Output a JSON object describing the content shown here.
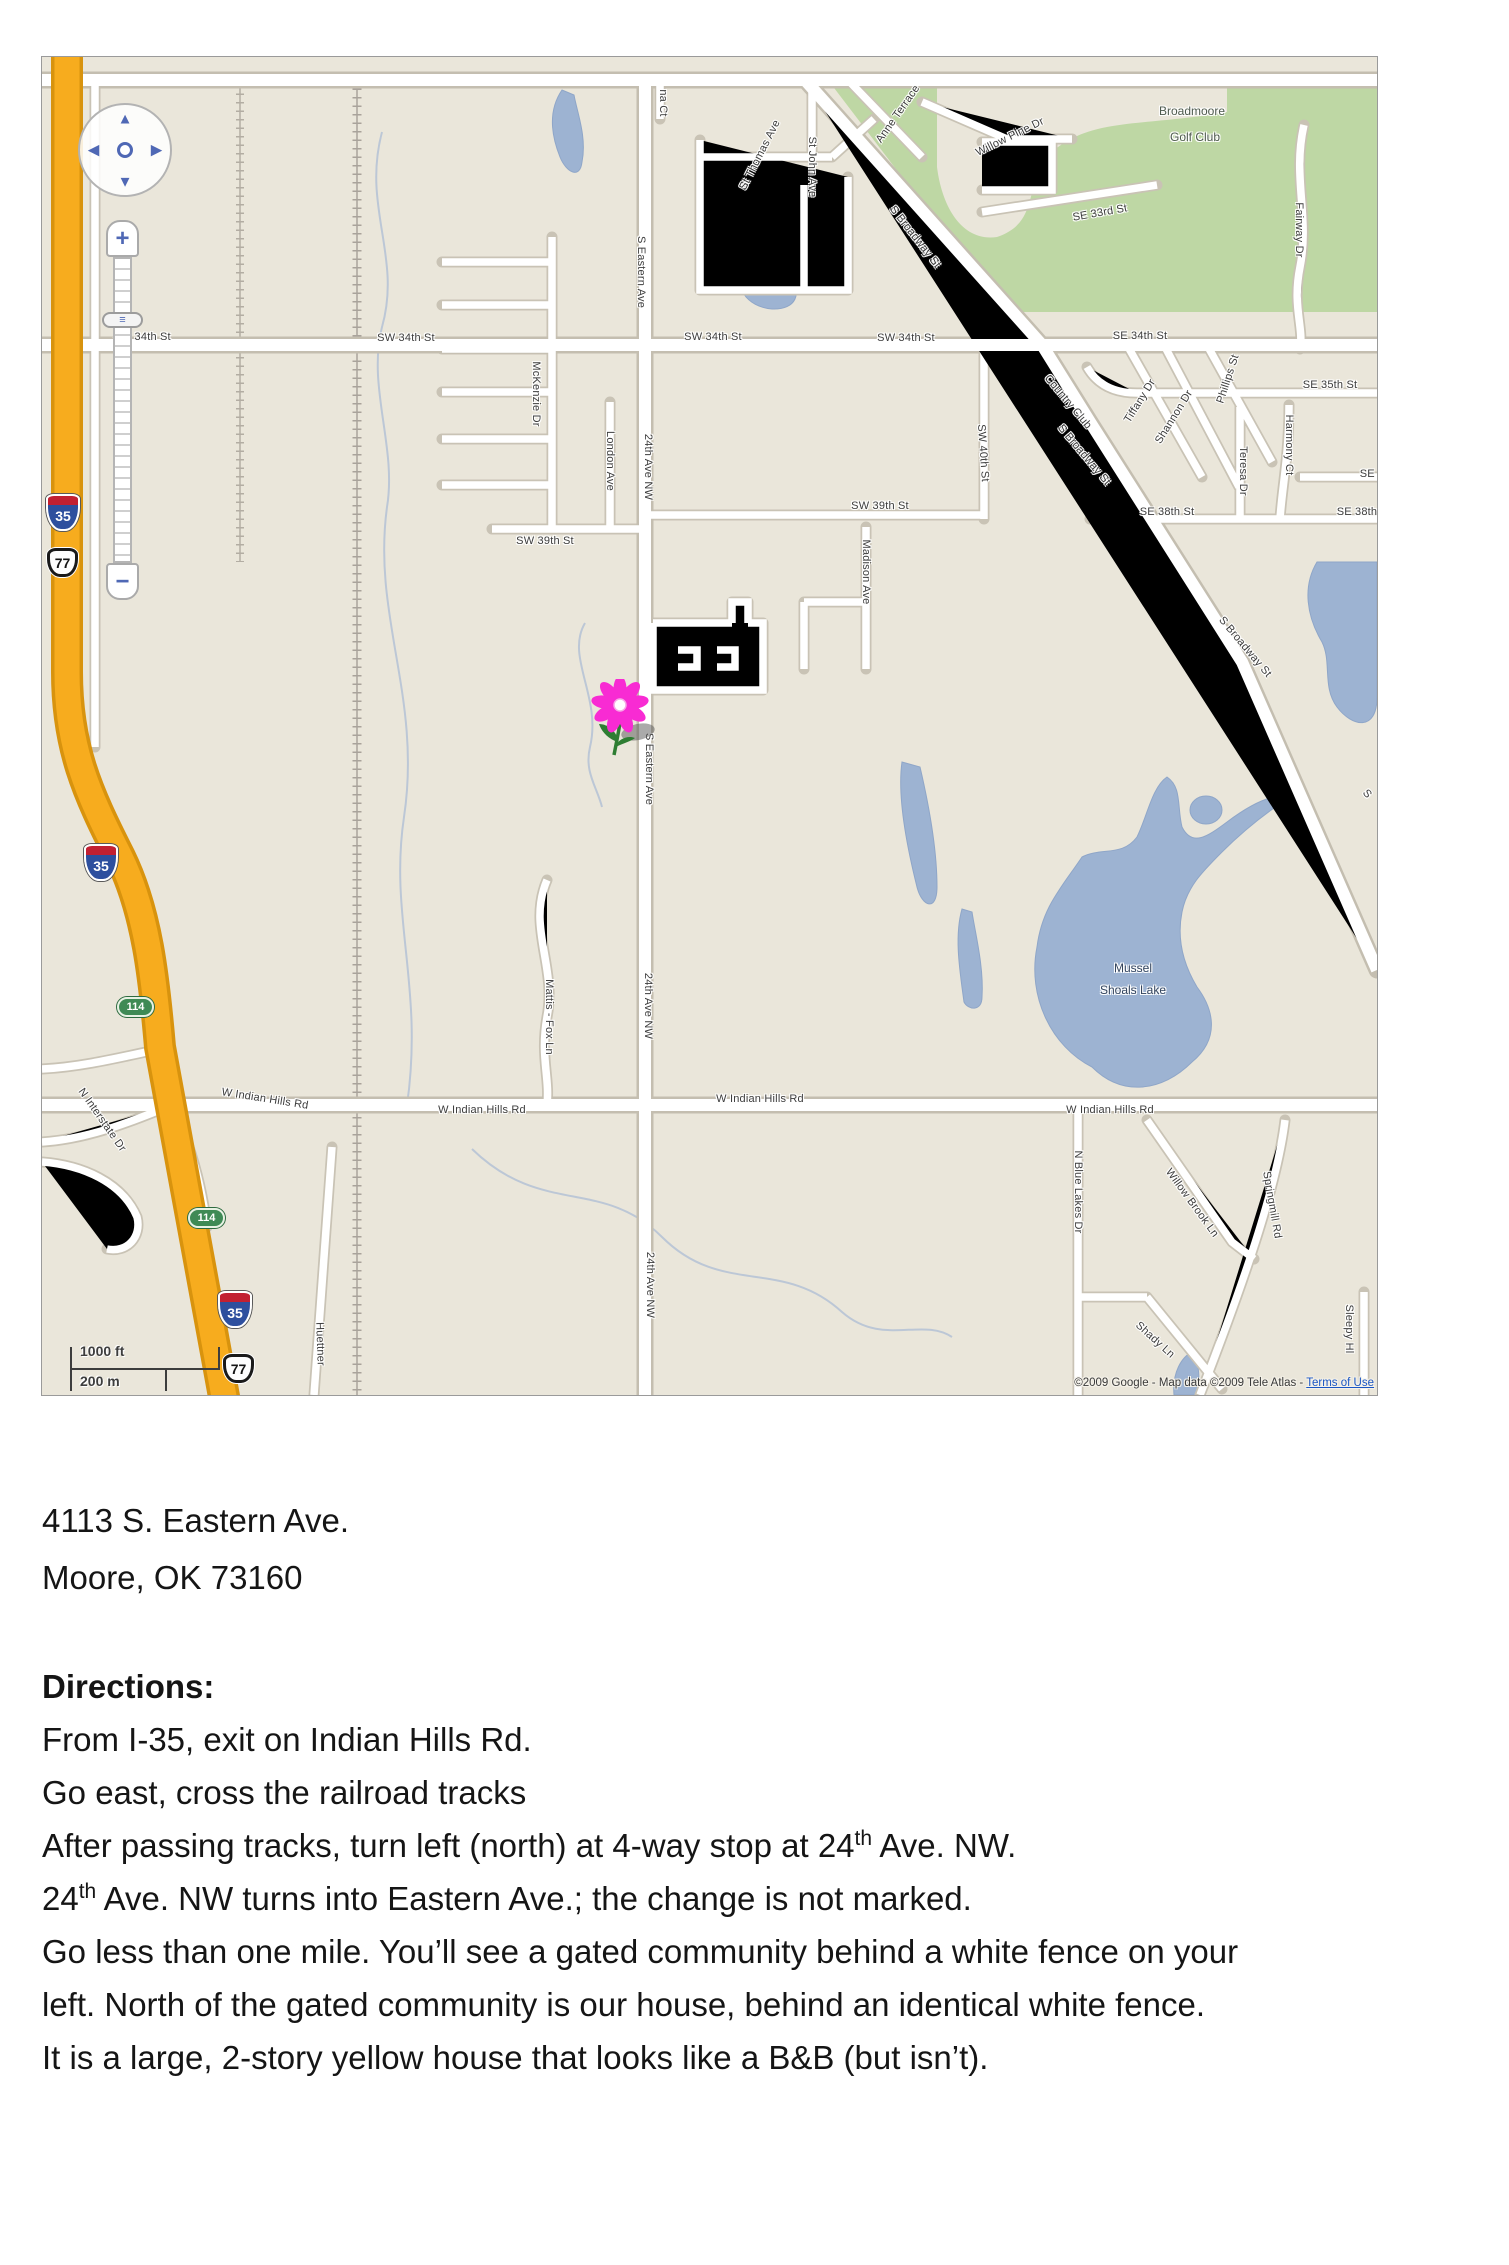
{
  "map": {
    "colors": {
      "land": "#EAE6DA",
      "park": "#BED7A4",
      "water": "#9DB3D2",
      "freeway": "#F7AC1E",
      "road": "#FFFFFF"
    },
    "places": {
      "golf_club": [
        "Broadmoore",
        "Golf Club"
      ],
      "lake": [
        "Mussel",
        "Shoals Lake"
      ]
    },
    "shields": {
      "interstate_35": "35",
      "us_77": "77",
      "ok_114": "114"
    },
    "street_labels": [
      "SW 34th St",
      "SW 34th St",
      "SW 34th St",
      "SW 34th St",
      "SE 34th St",
      "SW 39th St",
      "SW 39th St",
      "SE 35th St",
      "SE 37th St",
      "SE 38th St",
      "SE 38th St",
      "W Indian Hills Rd",
      "W Indian Hills Rd",
      "W Indian Hills Rd",
      "W Indian Hills Rd",
      "SE 33rd St",
      "Willow Pine Dr",
      "Anne Terrace",
      "St Thomas Ave",
      "St John Ave",
      "S Broadway St",
      "Country Club",
      "S Broadway St",
      "S Broadway St",
      "S",
      "Tiffany Dr",
      "Shannon Dr",
      "Phillips St",
      "Teresa Dr",
      "Harmony Ct",
      "Fairway Dr",
      "na Ct",
      "S Eastern Ave",
      "24th Ave NW",
      "McKenzie Dr",
      "London Ave",
      "SW 40th St",
      "Madison Ave",
      "S Eastern Ave",
      "24th Ave NW",
      "24th Ave NW",
      "Mattis - Fox Ln",
      "N Blue Lakes Dr",
      "Willow Brook Ln",
      "Springmill Rd",
      "Shady Ln",
      "Sleepy Hl",
      "Huettner",
      "N Interstate Dr"
    ],
    "controls": {
      "zoom_in": "+",
      "zoom_out": "−",
      "pan_up": "▲",
      "pan_down": "▼",
      "pan_left": "◀",
      "pan_right": "▶",
      "handle": "≡"
    },
    "scale": {
      "feet": "1000 ft",
      "meters": "200 m"
    },
    "copyright": {
      "prefix": "©2009 Google - Map data ©2009 Tele Atlas - ",
      "link": "Terms of Use"
    }
  },
  "address": {
    "line1": "4113 S. Eastern Ave.",
    "line2": "Moore, OK 73160"
  },
  "directions": {
    "heading": "Directions:",
    "line1": "From I-35, exit on Indian Hills Rd.",
    "line2": "Go east, cross the railroad tracks",
    "line3_pre": "After passing tracks, turn left (north) at 4-way stop at 24",
    "sup": "th",
    "line3_post": " Ave. NW.",
    "line4_pre": "24",
    "line4_post": " Ave. NW turns into Eastern Ave.; the change is not marked.",
    "line5": "Go less than one mile. You’ll see a gated community behind a white fence on your",
    "line6": "left. North of the gated community is our house, behind an identical white fence.",
    "line7": "It is a large, 2-story yellow house that looks like a B&B (but isn’t)."
  }
}
